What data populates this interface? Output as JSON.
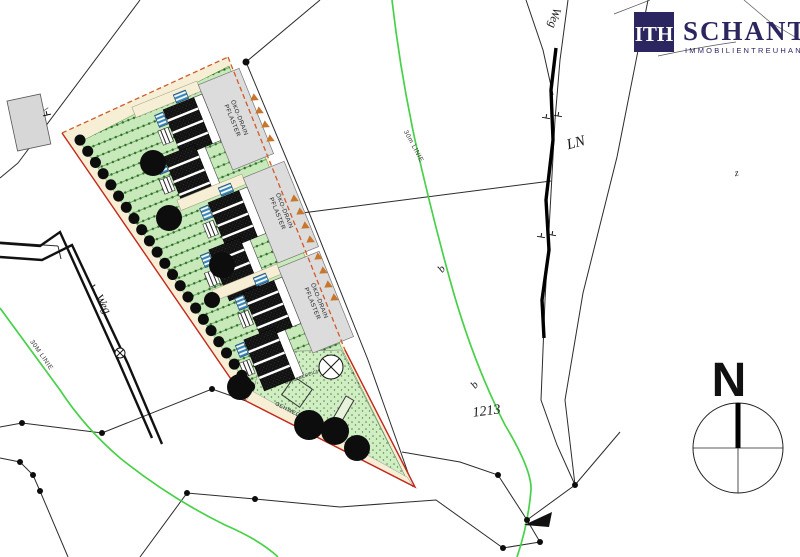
{
  "logo": {
    "monogram": "ITH",
    "name": "SCHANTL",
    "subtitle": "IMMOBILIENTREUHAND"
  },
  "compass": {
    "north_label": "N"
  },
  "plan_labels": {
    "oeko_drain_line1": "ÖKO-DRAIN",
    "oeko_drain_line2": "PFLASTER",
    "spielbereich": "SPIELBEREICH",
    "gehweg": "GEHWEG",
    "note_204": "204"
  },
  "map_labels": {
    "weg_left": "Weg",
    "weg_top_right": "Weg",
    "ln": "LN",
    "z": "z",
    "b_upper": "b",
    "b_lower": "b",
    "parcel_number": "1213",
    "line30_left": "30M LINIE",
    "line30_middle": "30m LINIE"
  },
  "colors": {
    "brand_navy": "#2b2660",
    "boundary_red": "#c4271b",
    "boundary_dash_orange": "#d05a28",
    "lawn_green": "#c8e9ba",
    "site_cream": "#f6efd6",
    "line_bright_green": "#3ecf3e",
    "slope_marker_orange": "#c8762c",
    "driveway_grey": "#dcdcdc"
  }
}
